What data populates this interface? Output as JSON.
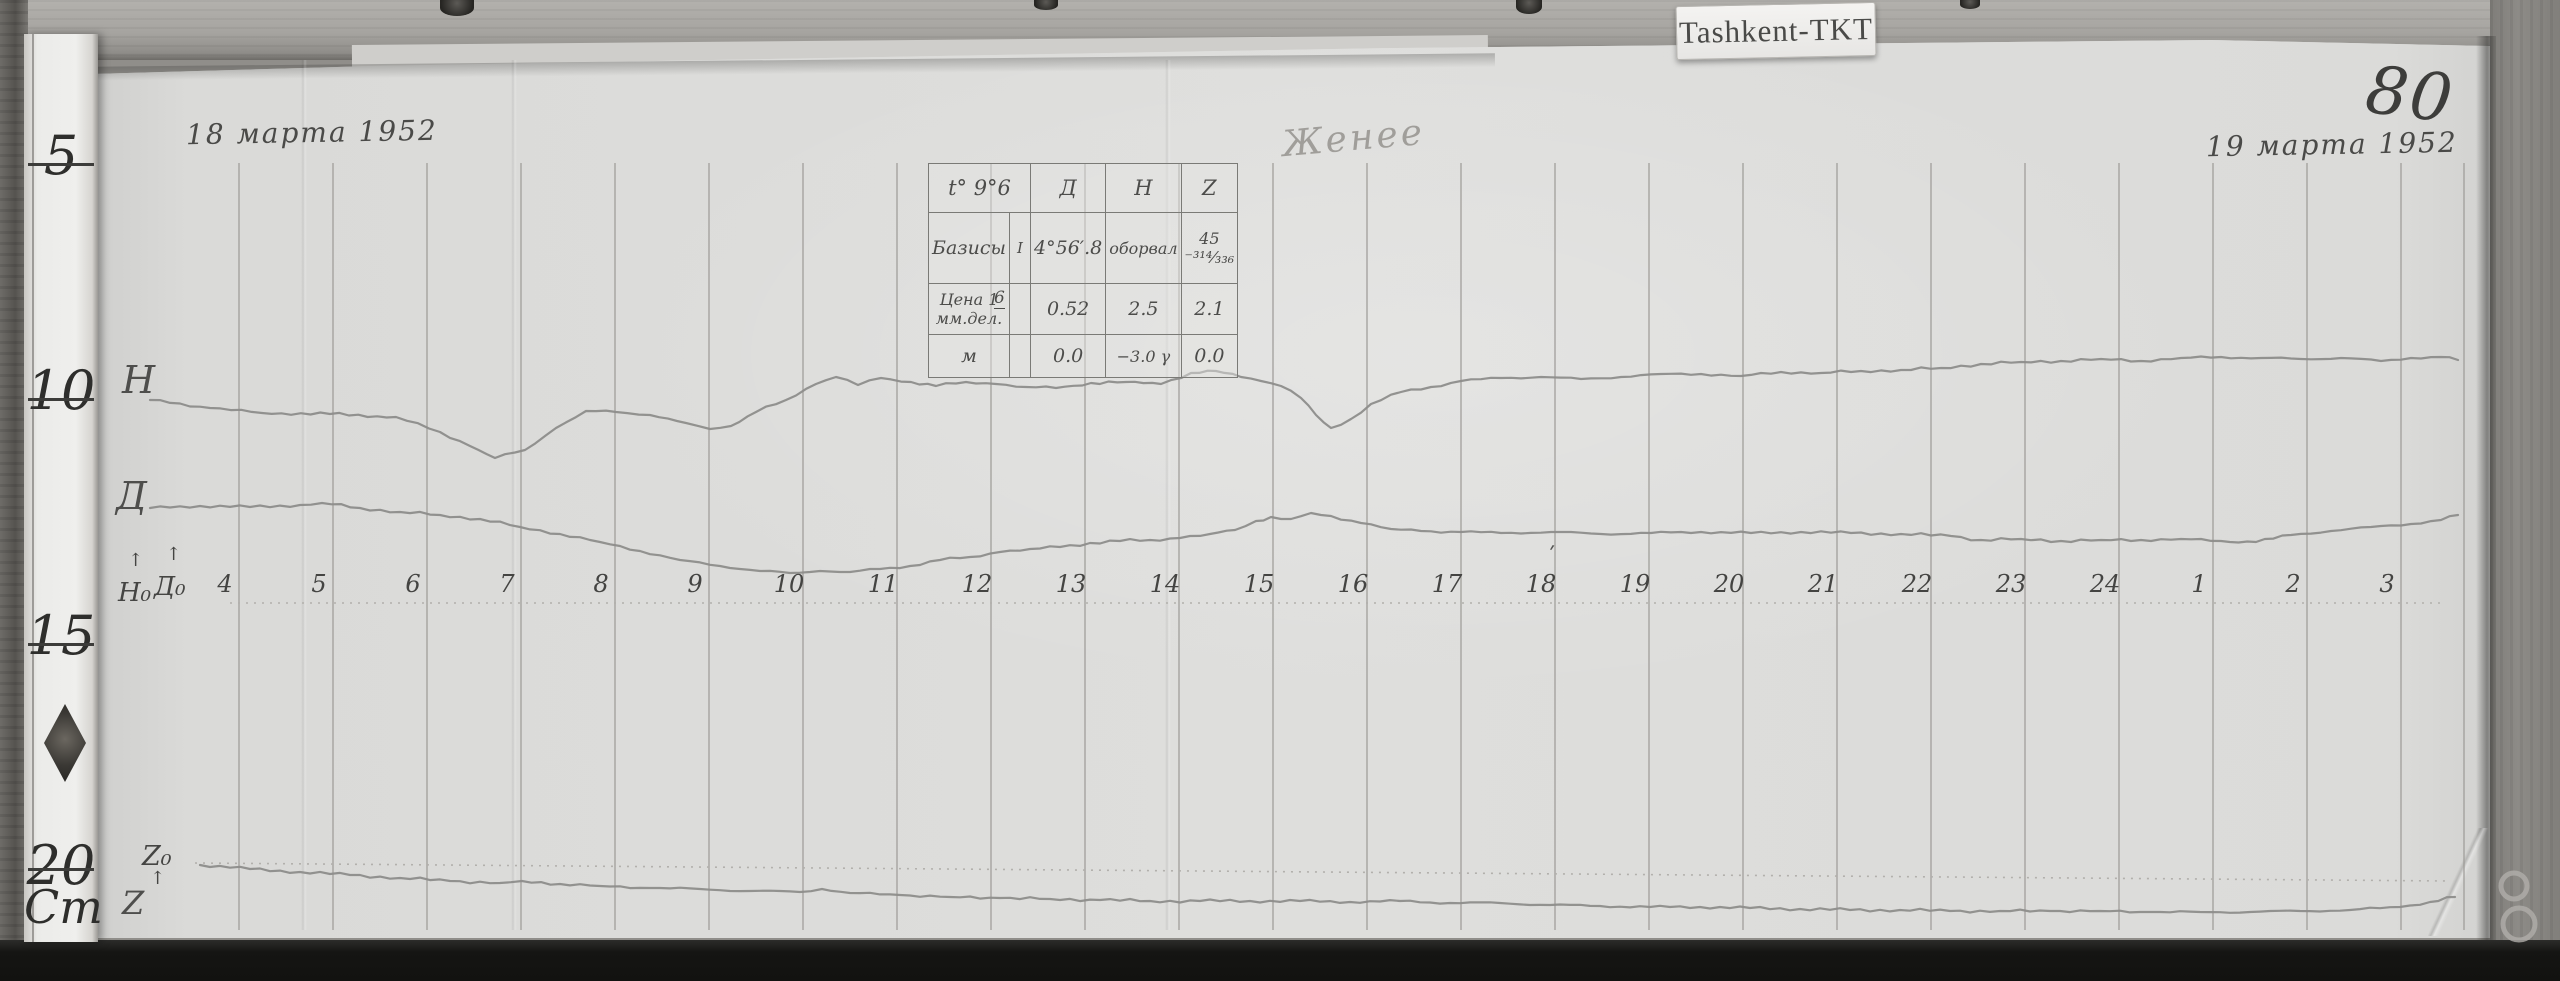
{
  "meta": {
    "station_label": "Tashkent-TKT",
    "page_number": "80"
  },
  "annotations": {
    "date_left": "18 марта 1952",
    "date_right": "19 марта 1952",
    "signature": "Женее",
    "trace_labels": {
      "h": "H",
      "d": "Д",
      "h_base": "H₀",
      "d_base": "Д₀",
      "z_base": "Z₀",
      "z": "Z",
      "arrow": "↑",
      "tick_over_18": "ʹ"
    }
  },
  "ruler": {
    "marks": [
      "5",
      "10",
      "15",
      "20"
    ],
    "unit": "Cm"
  },
  "table": {
    "header": {
      "c1": "t° 9°6",
      "d": "Д",
      "h": "H",
      "z": "Z"
    },
    "rows": {
      "bases": {
        "label": "Базисы",
        "sub": "І",
        "note": "6",
        "d": "4°56′.8",
        "h": "оборвал",
        "z": "45 ⁻³¹⁴⁄₃₃₆"
      },
      "scale": {
        "label": "Цена 1 мм.дел.",
        "d": "0.52",
        "h": "2.5",
        "z": "2.1"
      },
      "mu": {
        "label": "м",
        "d": "0.0",
        "h": "−3.0 γ",
        "z": "0.0"
      }
    }
  },
  "chart_data": {
    "type": "line",
    "title": "Магнитограмма Tashkent-TKT, 18–19 марта 1952",
    "xlabel": "часы (время)",
    "hours": [
      "4",
      "5",
      "6",
      "7",
      "8",
      "9",
      "10",
      "11",
      "12",
      "13",
      "14",
      "15",
      "16",
      "17",
      "18",
      "19",
      "20",
      "21",
      "22",
      "23",
      "24",
      "1",
      "2",
      "3"
    ],
    "scale_per_mm": {
      "D": "0.52′",
      "H": "2.5γ",
      "Z": "2.1γ"
    },
    "grid": {
      "first_line_x_px": 239,
      "spacing_px": 94,
      "y_top_px": 163,
      "y_bottom_px": 930,
      "edge_line_x_px": 2464,
      "label_offset_px": -14
    },
    "baselines": [
      {
        "name": "time-axis",
        "x1": 230,
        "y1": 603,
        "x2": 2440,
        "y2": 603
      },
      {
        "name": "z-zero",
        "x1": 195,
        "y1": 863,
        "x2": 2450,
        "y2": 881
      }
    ],
    "series": [
      {
        "name": "H",
        "points_px": [
          [
            150,
            400
          ],
          [
            210,
            408
          ],
          [
            262,
            413
          ],
          [
            330,
            414
          ],
          [
            396,
            417
          ],
          [
            440,
            432
          ],
          [
            470,
            446
          ],
          [
            495,
            458
          ],
          [
            525,
            450
          ],
          [
            556,
            428
          ],
          [
            586,
            411
          ],
          [
            616,
            412
          ],
          [
            650,
            415
          ],
          [
            686,
            423
          ],
          [
            710,
            429
          ],
          [
            731,
            426
          ],
          [
            756,
            412
          ],
          [
            786,
            400
          ],
          [
            816,
            384
          ],
          [
            836,
            377
          ],
          [
            858,
            385
          ],
          [
            881,
            378
          ],
          [
            911,
            382
          ],
          [
            936,
            386
          ],
          [
            966,
            382
          ],
          [
            996,
            384
          ],
          [
            1026,
            387
          ],
          [
            1056,
            388
          ],
          [
            1091,
            383
          ],
          [
            1126,
            382
          ],
          [
            1161,
            384
          ],
          [
            1191,
            373
          ],
          [
            1216,
            371
          ],
          [
            1241,
            377
          ],
          [
            1261,
            381
          ],
          [
            1281,
            386
          ],
          [
            1301,
            398
          ],
          [
            1316,
            415
          ],
          [
            1331,
            428
          ],
          [
            1351,
            419
          ],
          [
            1371,
            404
          ],
          [
            1401,
            392
          ],
          [
            1431,
            387
          ],
          [
            1461,
            381
          ],
          [
            1501,
            378
          ],
          [
            1541,
            377
          ],
          [
            1581,
            379
          ],
          [
            1621,
            377
          ],
          [
            1661,
            374
          ],
          [
            1701,
            374
          ],
          [
            1741,
            376
          ],
          [
            1781,
            372
          ],
          [
            1821,
            373
          ],
          [
            1861,
            371
          ],
          [
            1901,
            370
          ],
          [
            1941,
            368
          ],
          [
            1981,
            364
          ],
          [
            2021,
            362
          ],
          [
            2061,
            361
          ],
          [
            2101,
            359
          ],
          [
            2141,
            361
          ],
          [
            2181,
            358
          ],
          [
            2221,
            357
          ],
          [
            2261,
            358
          ],
          [
            2301,
            359
          ],
          [
            2341,
            358
          ],
          [
            2381,
            361
          ],
          [
            2411,
            358
          ],
          [
            2441,
            357
          ],
          [
            2458,
            360
          ]
        ]
      },
      {
        "name": "D",
        "points_px": [
          [
            150,
            508
          ],
          [
            200,
            506
          ],
          [
            250,
            507
          ],
          [
            300,
            505
          ],
          [
            322,
            503
          ],
          [
            360,
            508
          ],
          [
            400,
            512
          ],
          [
            440,
            515
          ],
          [
            480,
            519
          ],
          [
            520,
            527
          ],
          [
            560,
            534
          ],
          [
            600,
            542
          ],
          [
            640,
            551
          ],
          [
            680,
            560
          ],
          [
            720,
            566
          ],
          [
            760,
            571
          ],
          [
            790,
            573
          ],
          [
            820,
            571
          ],
          [
            850,
            572
          ],
          [
            880,
            569
          ],
          [
            910,
            566
          ],
          [
            940,
            560
          ],
          [
            970,
            557
          ],
          [
            1000,
            552
          ],
          [
            1030,
            549
          ],
          [
            1060,
            547
          ],
          [
            1090,
            543
          ],
          [
            1120,
            541
          ],
          [
            1150,
            540
          ],
          [
            1180,
            538
          ],
          [
            1210,
            534
          ],
          [
            1235,
            530
          ],
          [
            1256,
            521
          ],
          [
            1271,
            517
          ],
          [
            1291,
            519
          ],
          [
            1311,
            513
          ],
          [
            1331,
            516
          ],
          [
            1361,
            523
          ],
          [
            1391,
            529
          ],
          [
            1421,
            531
          ],
          [
            1461,
            532
          ],
          [
            1501,
            533
          ],
          [
            1551,
            532
          ],
          [
            1601,
            534
          ],
          [
            1651,
            533
          ],
          [
            1701,
            532
          ],
          [
            1751,
            533
          ],
          [
            1801,
            532
          ],
          [
            1851,
            533
          ],
          [
            1901,
            534
          ],
          [
            1951,
            536
          ],
          [
            1981,
            540
          ],
          [
            2021,
            539
          ],
          [
            2061,
            541
          ],
          [
            2101,
            540
          ],
          [
            2141,
            540
          ],
          [
            2181,
            539
          ],
          [
            2221,
            541
          ],
          [
            2256,
            542
          ],
          [
            2291,
            535
          ],
          [
            2331,
            531
          ],
          [
            2371,
            527
          ],
          [
            2411,
            524
          ],
          [
            2441,
            520
          ],
          [
            2458,
            515
          ]
        ]
      },
      {
        "name": "Z",
        "points_px": [
          [
            200,
            865
          ],
          [
            250,
            869
          ],
          [
            300,
            872
          ],
          [
            350,
            875
          ],
          [
            400,
            878
          ],
          [
            450,
            881
          ],
          [
            500,
            883
          ],
          [
            522,
            881
          ],
          [
            560,
            884
          ],
          [
            600,
            886
          ],
          [
            650,
            888
          ],
          [
            700,
            889
          ],
          [
            750,
            891
          ],
          [
            800,
            892
          ],
          [
            822,
            889
          ],
          [
            850,
            893
          ],
          [
            900,
            895
          ],
          [
            950,
            897
          ],
          [
            1000,
            898
          ],
          [
            1050,
            899
          ],
          [
            1100,
            900
          ],
          [
            1150,
            901
          ],
          [
            1200,
            901
          ],
          [
            1250,
            901
          ],
          [
            1300,
            901
          ],
          [
            1350,
            902
          ],
          [
            1400,
            901
          ],
          [
            1450,
            903
          ],
          [
            1500,
            903
          ],
          [
            1550,
            905
          ],
          [
            1600,
            906
          ],
          [
            1650,
            907
          ],
          [
            1700,
            907
          ],
          [
            1750,
            908
          ],
          [
            1800,
            909
          ],
          [
            1850,
            910
          ],
          [
            1900,
            910
          ],
          [
            1950,
            911
          ],
          [
            2000,
            911
          ],
          [
            2050,
            911
          ],
          [
            2100,
            911
          ],
          [
            2150,
            912
          ],
          [
            2200,
            912
          ],
          [
            2250,
            912
          ],
          [
            2300,
            911
          ],
          [
            2350,
            910
          ],
          [
            2400,
            907
          ],
          [
            2430,
            902
          ],
          [
            2455,
            897
          ]
        ]
      }
    ]
  }
}
